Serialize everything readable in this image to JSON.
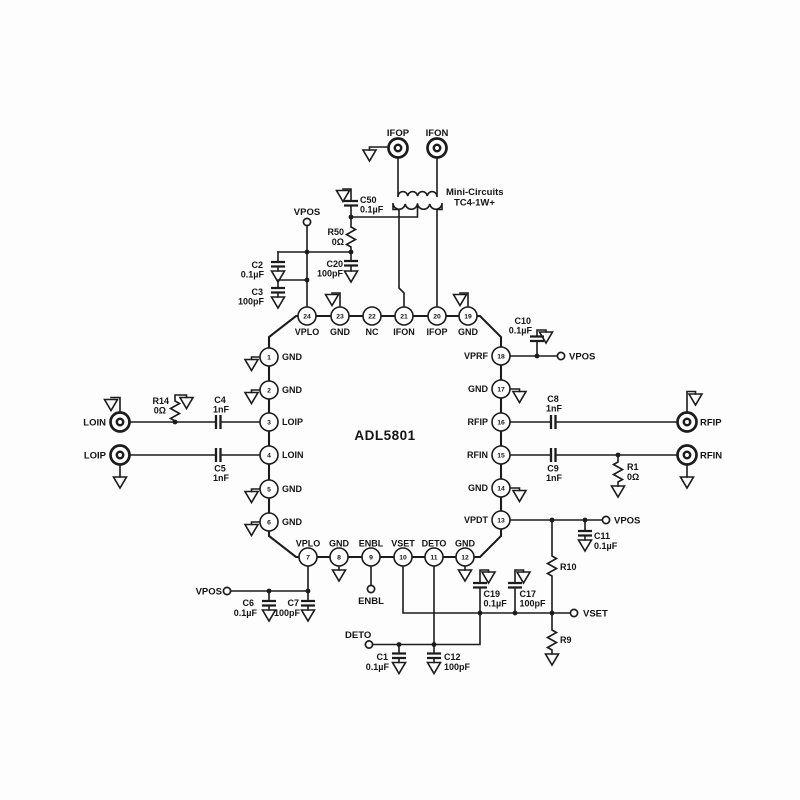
{
  "chip": {
    "name": "ADL5801",
    "pins": [
      {
        "num": "1",
        "name": "GND"
      },
      {
        "num": "2",
        "name": "GND"
      },
      {
        "num": "3",
        "name": "LOIP"
      },
      {
        "num": "4",
        "name": "LOIN"
      },
      {
        "num": "5",
        "name": "GND"
      },
      {
        "num": "6",
        "name": "GND"
      },
      {
        "num": "7",
        "name": "VPLO"
      },
      {
        "num": "8",
        "name": "GND"
      },
      {
        "num": "9",
        "name": "ENBL"
      },
      {
        "num": "10",
        "name": "VSET"
      },
      {
        "num": "11",
        "name": "DETO"
      },
      {
        "num": "12",
        "name": "GND"
      },
      {
        "num": "13",
        "name": "VPDT"
      },
      {
        "num": "14",
        "name": "GND"
      },
      {
        "num": "15",
        "name": "RFIN"
      },
      {
        "num": "16",
        "name": "RFIP"
      },
      {
        "num": "17",
        "name": "GND"
      },
      {
        "num": "18",
        "name": "VPRF"
      },
      {
        "num": "19",
        "name": "GND"
      },
      {
        "num": "20",
        "name": "IFOP"
      },
      {
        "num": "21",
        "name": "IFON"
      },
      {
        "num": "22",
        "name": "NC"
      },
      {
        "num": "23",
        "name": "GND"
      },
      {
        "num": "24",
        "name": "VPLO"
      }
    ]
  },
  "transformer": {
    "vendor": "Mini-Circuits",
    "part": "TC4-1W+"
  },
  "connectors": {
    "ifop": "IFOP",
    "ifon": "IFON",
    "loin": "LOIN",
    "loip": "LOIP",
    "rfip": "RFIP",
    "rfin": "RFIN"
  },
  "terminals": {
    "vpos": "VPOS",
    "enbl": "ENBL",
    "deto": "DETO",
    "vset": "VSET"
  },
  "components": {
    "c50": {
      "ref": "C50",
      "value": "0.1µF"
    },
    "r50": {
      "ref": "R50",
      "value": "0Ω"
    },
    "c2": {
      "ref": "C2",
      "value": "0.1µF"
    },
    "c20": {
      "ref": "C20",
      "value": "100pF"
    },
    "c3": {
      "ref": "C3",
      "value": "100pF"
    },
    "c10": {
      "ref": "C10",
      "value": "0.1µF"
    },
    "c8": {
      "ref": "C8",
      "value": "1nF"
    },
    "c9": {
      "ref": "C9",
      "value": "1nF"
    },
    "r1": {
      "ref": "R1",
      "value": "0Ω"
    },
    "r14": {
      "ref": "R14",
      "value": "0Ω"
    },
    "c4": {
      "ref": "C4",
      "value": "1nF"
    },
    "c5": {
      "ref": "C5",
      "value": "1nF"
    },
    "c6": {
      "ref": "C6",
      "value": "0.1µF"
    },
    "c7": {
      "ref": "C7",
      "value": "100pF"
    },
    "c11": {
      "ref": "C11",
      "value": "0.1µF"
    },
    "r10": {
      "ref": "R10"
    },
    "r9": {
      "ref": "R9"
    },
    "c19": {
      "ref": "C19",
      "value": "0.1µF"
    },
    "c17": {
      "ref": "C17",
      "value": "100pF"
    },
    "c1": {
      "ref": "C1",
      "value": "0.1µF"
    },
    "c12": {
      "ref": "C12",
      "value": "100pF"
    }
  },
  "colors": {
    "line": "#1c1c1c",
    "background": "#ffffff"
  }
}
